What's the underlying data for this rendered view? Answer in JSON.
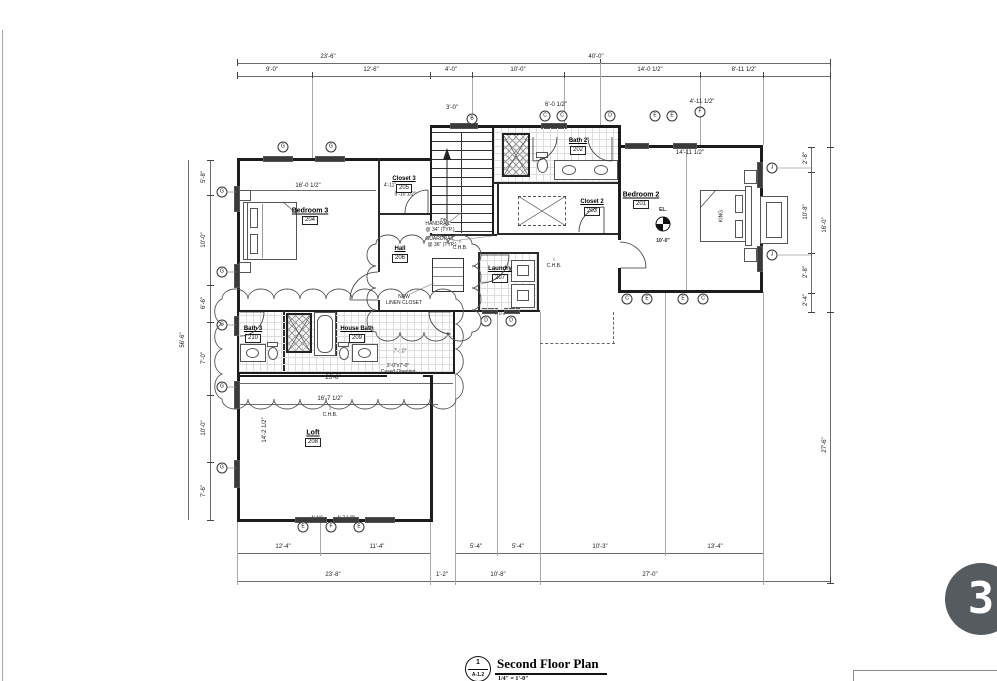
{
  "title_block": {
    "detail_number": "1",
    "sheet": "A-1.2",
    "title": "Second Floor Plan",
    "scale": "1/4\" = 1'-0\""
  },
  "photo_badge": {
    "label": "3"
  },
  "rooms": [
    {
      "name": "Bedroom 3",
      "number": "204"
    },
    {
      "name": "Closet 3",
      "number": "205"
    },
    {
      "name": "Bath 2",
      "number": "202"
    },
    {
      "name": "Closet 2",
      "number": "203"
    },
    {
      "name": "Bedroom 2",
      "number": "201"
    },
    {
      "name": "Hall",
      "number": "206"
    },
    {
      "name": "Laundry",
      "number": "207"
    },
    {
      "name": "Bath 3",
      "number": "210"
    },
    {
      "name": "House Bath",
      "number": "209"
    },
    {
      "name": "Loft",
      "number": "208"
    }
  ],
  "notes": {
    "handrail1": "HANDRAIL",
    "handrail2": "@ 34\" (TYP.)",
    "guardrail1": "GUARDRAIL",
    "guardrail2": "@ 36\" (TYP.)",
    "linen1": "NEW",
    "linen2": "LINEN CLOSET",
    "cased1": "3'-0\"x7'-0\"",
    "cased2": "Cased Opening",
    "el": "EL.",
    "el_value": "10'-0\"",
    "dn": "DN",
    "chb_sym": "○",
    "chb": "C.H.B.",
    "king": "KING"
  },
  "dims": {
    "t1": "23'-6\"",
    "t2": "40'-0\"",
    "t3": "9'-0\"",
    "t4": "12'-6\"",
    "t5": "4'-0\"",
    "t6": "10'-0\"",
    "t7": "14'-0 1/2\"",
    "t8": "8'-11 1/2\"",
    "t9": "3'-0\"",
    "t10": "6'-0 1/2\"",
    "t11": "4'-11 1/2\"",
    "l1": "5'-8\"",
    "l2": "10'-0\"",
    "l3": "6'-6\"",
    "l4": "7'-0\"",
    "l5": "10'-0\"",
    "l6": "7'-6\"",
    "l7": "56'-6\"",
    "r1": "2'-8\"",
    "r2": "10'-8\"",
    "r3": "2'-8\"",
    "r4": "2'-4\"",
    "r5": "16'-0\"",
    "r6": "27'-6\"",
    "b1": "12'-4\"",
    "b2": "11'-4\"",
    "b3": "23'-8\"",
    "b4": "1'-2\"",
    "b5": "5'-4\"",
    "b6": "5'-4\"",
    "b7": "10'-3\"",
    "b8": "13'-4\"",
    "b9": "10'-8\"",
    "b10": "27'-0\"",
    "b11": "4'-0 1/2\"",
    "b12": "4'-11\"",
    "b13": "4'-7 1/2\"",
    "i1": "16'-0 1/2\"",
    "i2": "4'-11\"",
    "i3": "5'-10 1/2\"",
    "i4": "14'-11 1/2\"",
    "i5": "23'-8\"",
    "i6": "16'-7 1/2\"",
    "i7": "6'-8\"",
    "i8": "14'-2 1/2\"",
    "i9": "7'-6\"",
    "i10": "7'-10\""
  },
  "tags": [
    "B",
    "C",
    "C",
    "D",
    "E",
    "E",
    "F",
    "G",
    "G",
    "G",
    "G",
    "G",
    "G",
    "G",
    "J",
    "J",
    "E",
    "F",
    "E",
    "D",
    "D",
    "C",
    "E",
    "E",
    "C"
  ]
}
